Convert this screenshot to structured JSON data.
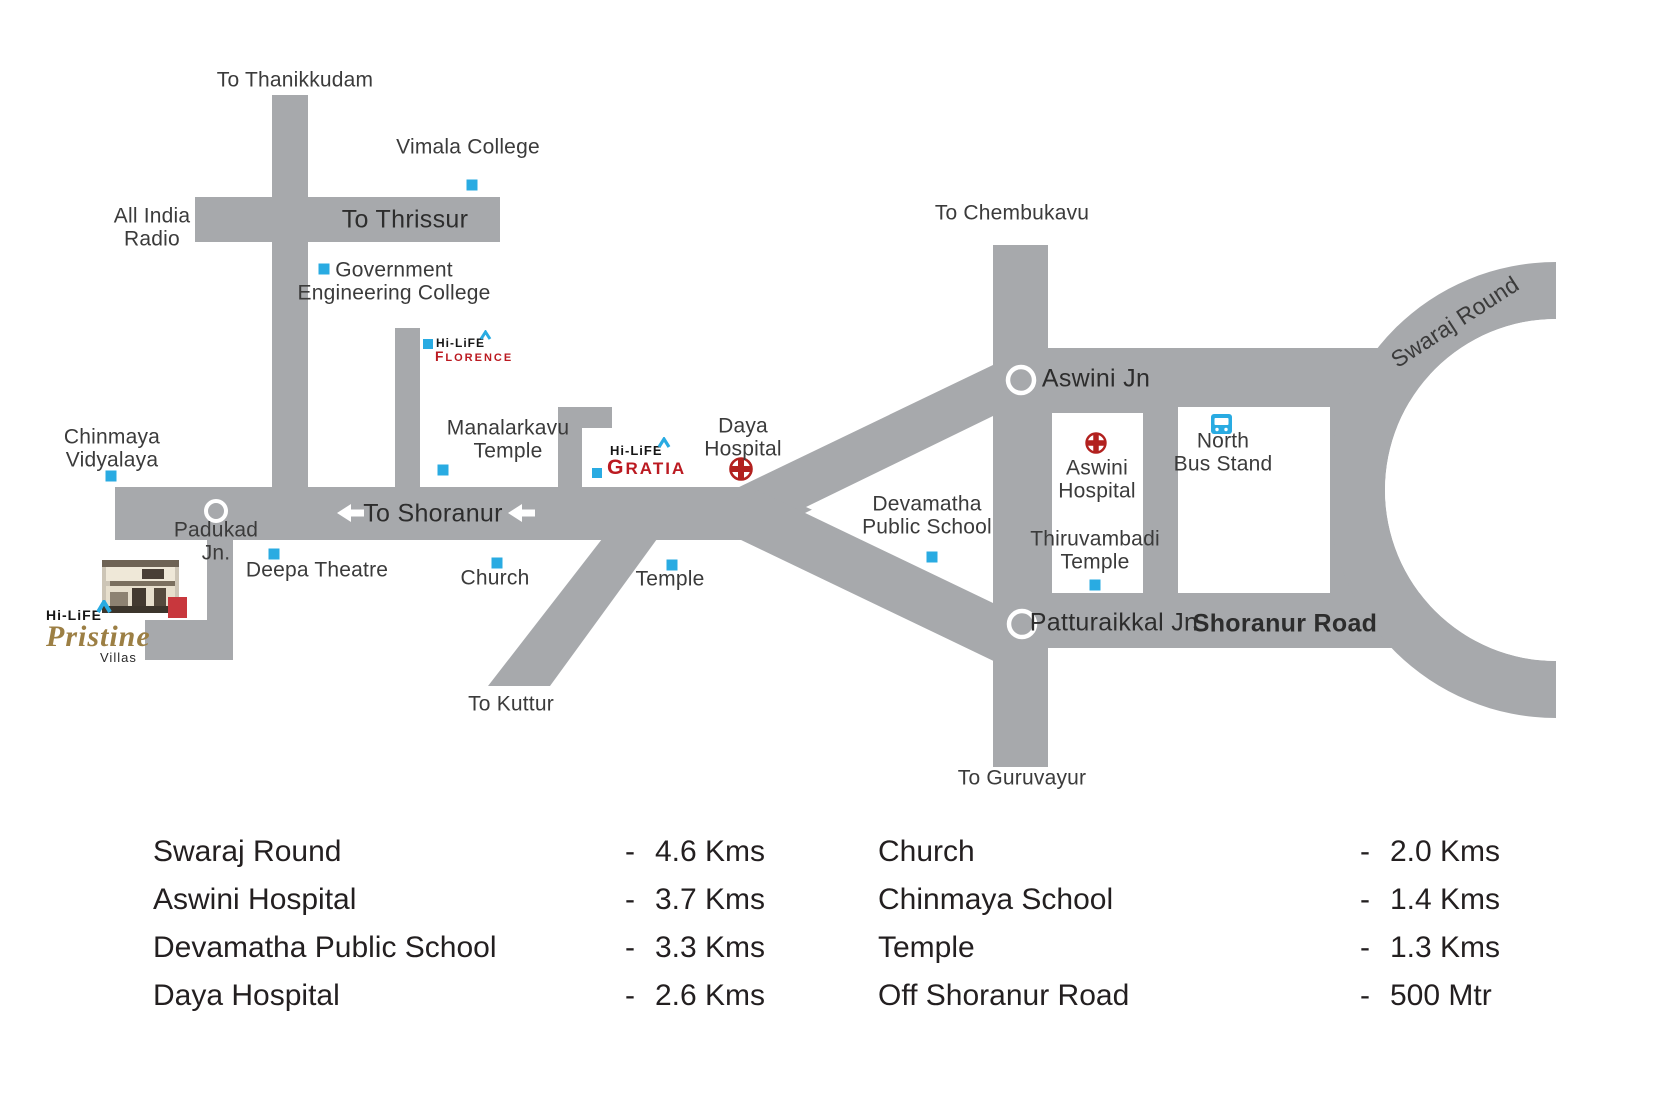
{
  "theme": {
    "road_gray": "#a7a9ac",
    "marker_blue": "#29abe2",
    "cross_red": "#b2211f",
    "logo_red": "#bb1a21",
    "map_text": "#3b3b3b",
    "table_text": "#231f20",
    "pristine_gold": "#9c7f44"
  },
  "map": {
    "labels": [
      {
        "name": "label-to-thanikkudam",
        "lines": [
          "To Thanikkudam"
        ],
        "x": 295,
        "y": 81
      },
      {
        "name": "label-vimala-college",
        "lines": [
          "Vimala College"
        ],
        "x": 468,
        "y": 148
      },
      {
        "name": "label-all-india-radio",
        "lines": [
          "All India",
          "Radio"
        ],
        "x": 152,
        "y": 228
      },
      {
        "name": "label-to-thrissur",
        "lines": [
          "To Thrissur"
        ],
        "x": 405,
        "y": 220,
        "road": true
      },
      {
        "name": "label-govt-engineering-college",
        "lines": [
          "Government",
          "Engineering College"
        ],
        "x": 394,
        "y": 282
      },
      {
        "name": "label-manalarkavu-temple",
        "lines": [
          "Manalarkavu",
          "Temple"
        ],
        "x": 508,
        "y": 440
      },
      {
        "name": "label-chinmaya-vidyalaya",
        "lines": [
          "Chinmaya",
          "Vidyalaya"
        ],
        "x": 112,
        "y": 449
      },
      {
        "name": "label-padukad-jn",
        "lines": [
          "Padukad",
          "Jn."
        ],
        "x": 216,
        "y": 542
      },
      {
        "name": "label-deepa-theatre",
        "lines": [
          "Deepa Theatre"
        ],
        "x": 317,
        "y": 571
      },
      {
        "name": "label-church",
        "lines": [
          "Church"
        ],
        "x": 495,
        "y": 579
      },
      {
        "name": "label-temple",
        "lines": [
          "Temple"
        ],
        "x": 670,
        "y": 580
      },
      {
        "name": "label-to-kuttur",
        "lines": [
          "To Kuttur"
        ],
        "x": 511,
        "y": 705
      },
      {
        "name": "label-daya-hospital",
        "lines": [
          "Daya",
          "Hospital"
        ],
        "x": 743,
        "y": 438
      },
      {
        "name": "label-devamatha-public-school",
        "lines": [
          "Devamatha",
          "Public School"
        ],
        "x": 927,
        "y": 516
      },
      {
        "name": "label-to-shoranur",
        "lines": [
          "To Shoranur"
        ],
        "x": 433,
        "y": 514,
        "road": true
      },
      {
        "name": "label-aswini-jn",
        "lines": [
          "Aswini Jn"
        ],
        "x": 1096,
        "y": 379,
        "road": true
      },
      {
        "name": "label-to-chembukavu",
        "lines": [
          "To Chembukavu"
        ],
        "x": 1012,
        "y": 214
      },
      {
        "name": "label-aswini-hospital",
        "lines": [
          "Aswini",
          "Hospital"
        ],
        "x": 1097,
        "y": 480
      },
      {
        "name": "label-thiruvambadi-temple",
        "lines": [
          "Thiruvambadi",
          "Temple"
        ],
        "x": 1095,
        "y": 551
      },
      {
        "name": "label-north-bus-stand",
        "lines": [
          "North",
          "Bus Stand"
        ],
        "x": 1223,
        "y": 453
      },
      {
        "name": "label-patturaikkal-jn",
        "lines": [
          "Patturaikkal Jn"
        ],
        "x": 1114,
        "y": 623,
        "road": true
      },
      {
        "name": "label-shoranur-road",
        "lines": [
          "Shoranur Road"
        ],
        "x": 1285,
        "y": 624,
        "road": true,
        "weight": 700
      },
      {
        "name": "label-to-guruvayur",
        "lines": [
          "To Guruvayur"
        ],
        "x": 1022,
        "y": 779
      },
      {
        "name": "label-swaraj-round",
        "lines": [
          "Swaraj Round"
        ],
        "x": 1455,
        "y": 322,
        "rotate": -33,
        "size": 23
      }
    ],
    "markers": [
      {
        "name": "marker-vimala-college",
        "x": 472,
        "y": 185
      },
      {
        "name": "marker-govt-engineering-college",
        "x": 324,
        "y": 269
      },
      {
        "name": "marker-manalarkavu-temple",
        "x": 443,
        "y": 470
      },
      {
        "name": "marker-chinmaya-vidyalaya",
        "x": 111,
        "y": 476
      },
      {
        "name": "marker-deepa-theatre",
        "x": 274,
        "y": 554
      },
      {
        "name": "marker-church",
        "x": 497,
        "y": 563
      },
      {
        "name": "marker-temple",
        "x": 672,
        "y": 565
      },
      {
        "name": "marker-devamatha-public-school",
        "x": 932,
        "y": 557
      },
      {
        "name": "marker-thiruvambadi-temple",
        "x": 1095,
        "y": 585
      }
    ],
    "logos": {
      "florence": {
        "brand": "Hi-LiFE",
        "project": "FLORENCE"
      },
      "gratia": {
        "brand": "Hi-LiFE",
        "project": "GRATIA"
      },
      "pristine": {
        "brand": "Hi-LiFE",
        "project": "Pristine",
        "suffix": "Villas"
      }
    }
  },
  "distances": {
    "separator": "-",
    "left": [
      {
        "label": "Swaraj Round",
        "value": "4.6 Kms"
      },
      {
        "label": "Aswini Hospital",
        "value": "3.7 Kms"
      },
      {
        "label": "Devamatha Public School",
        "value": "3.3 Kms"
      },
      {
        "label": "Daya Hospital",
        "value": "2.6 Kms"
      }
    ],
    "right": [
      {
        "label": "Church",
        "value": "2.0 Kms"
      },
      {
        "label": "Chinmaya School",
        "value": "1.4 Kms"
      },
      {
        "label": "Temple",
        "value": "1.3 Kms"
      },
      {
        "label": "Off Shoranur Road",
        "value": "500 Mtr"
      }
    ]
  }
}
